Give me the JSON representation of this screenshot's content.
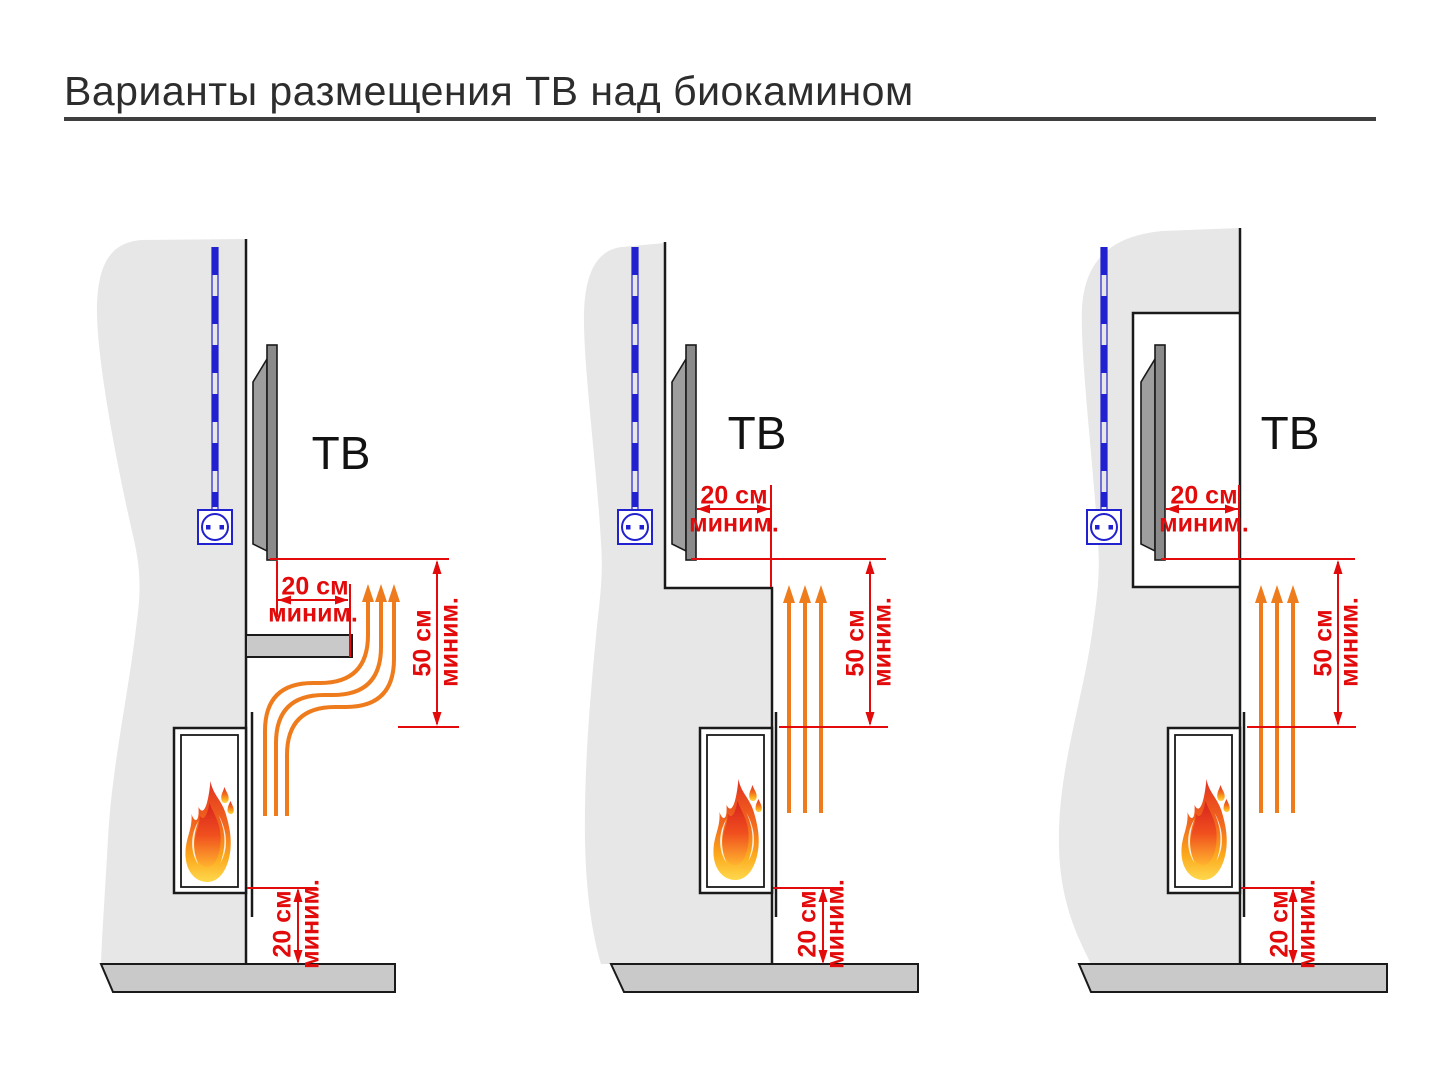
{
  "title": "Варианты размещения ТВ над биокамином",
  "colors": {
    "accent_red": "#e20a0a",
    "flame_orange": "#ee7c1d",
    "cable_blue": "#2121cf",
    "wall_gray": "#e7e7e7",
    "floor_gray": "#c9c9c9",
    "tv_gray": "#8a8a8a",
    "outline": "#1a1a1a"
  },
  "variants": [
    {
      "tv_label": "ТВ",
      "front_gap_value": "20 см",
      "front_gap_min": "миним.",
      "top_gap_value": "50 см",
      "top_gap_min": "миним.",
      "floor_gap_value": "20 см",
      "floor_gap_min": "миним."
    },
    {
      "tv_label": "ТВ",
      "front_gap_value": "20 см",
      "front_gap_min": "миним.",
      "top_gap_value": "50 см",
      "top_gap_min": "миним.",
      "floor_gap_value": "20 см",
      "floor_gap_min": "миним."
    },
    {
      "tv_label": "ТВ",
      "front_gap_value": "20 см",
      "front_gap_min": "миним.",
      "top_gap_value": "50 см",
      "top_gap_min": "миним.",
      "floor_gap_value": "20 см",
      "floor_gap_min": "миним."
    }
  ]
}
